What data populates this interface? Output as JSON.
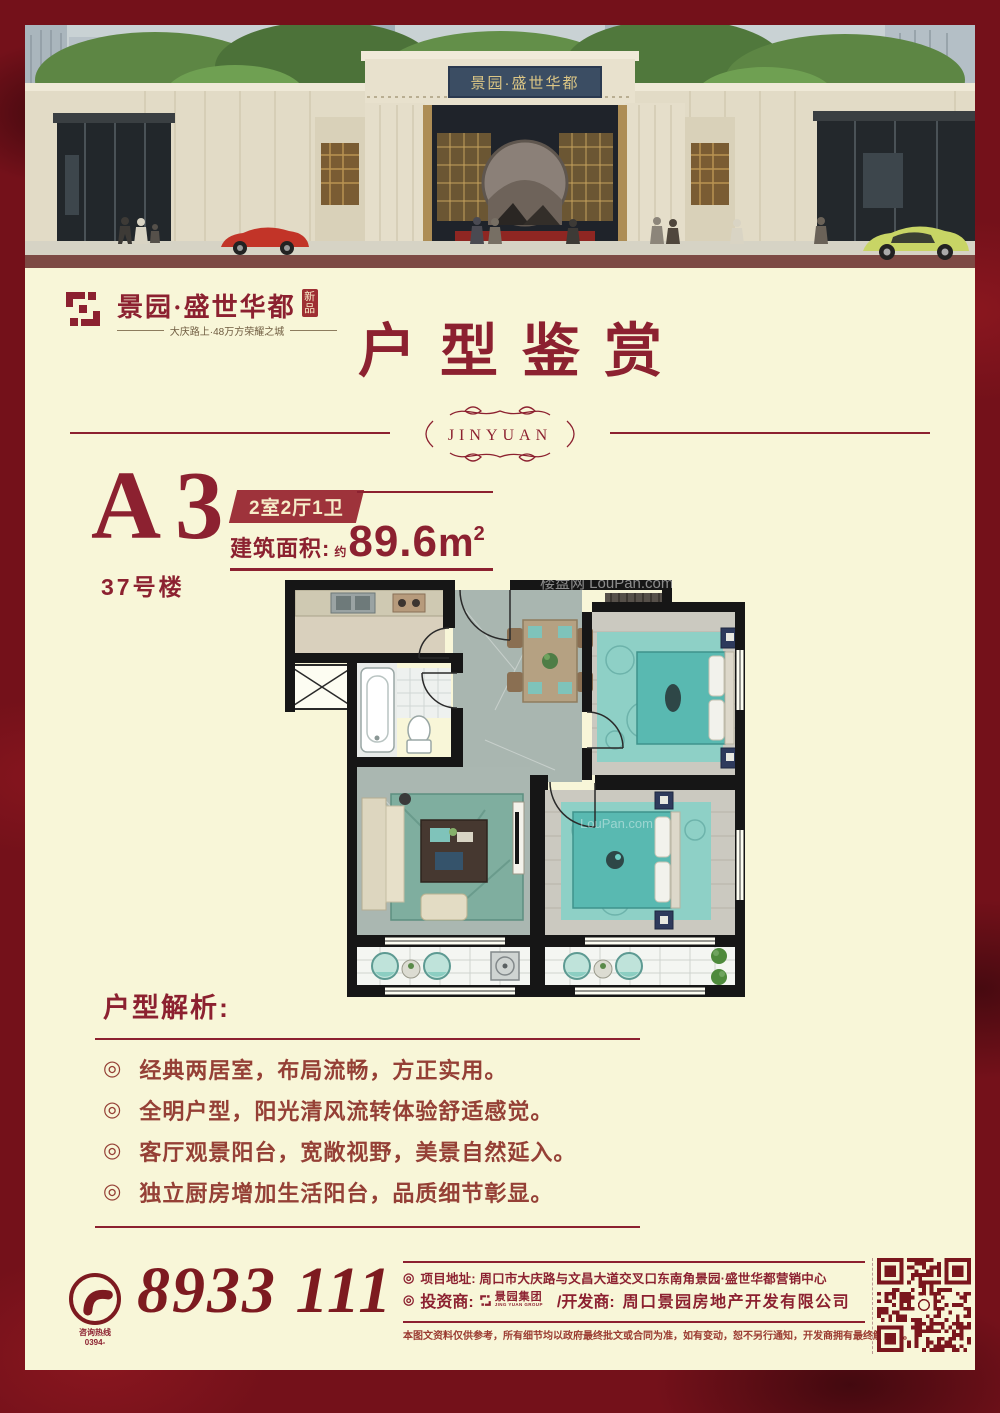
{
  "colors": {
    "accent": "#8c2130",
    "accent_dark": "#7a161d",
    "cream": "#f8f6d8",
    "frame_red": "#74111a",
    "badge_bg": "#9e333b",
    "bullet_text": "#954036",
    "plaque_navy": "#3b4d63",
    "plaque_gold": "#dcc685",
    "floorplan_teal": "#5fbdb5",
    "floorplan_navy": "#2e3a5c"
  },
  "brand": {
    "name": "景园·盛世华都",
    "badge": "新品",
    "tagline": "大庆路上·48万方荣耀之城"
  },
  "hero": {
    "plaque_text": "景园·盛世华都"
  },
  "header": {
    "title": "户型鉴赏",
    "ornament_text": "JINYUAN"
  },
  "unit": {
    "code": "A3",
    "building": "37号楼",
    "layout_badge": "2室2厅1卫",
    "area_label": "建筑面积:",
    "area_prefix": "约",
    "area_value": "89.6",
    "area_unit": "m",
    "area_power": "2"
  },
  "floorplan": {
    "watermark_top": "楼盘网 LouPan.com",
    "watermark_mid": "LouPan.com"
  },
  "analysis": {
    "heading": "户型解析:",
    "bullet_glyph": "◎",
    "items": [
      "经典两居室，布局流畅，方正实用。",
      "全明户型，阳光清风流转体验舒适感觉。",
      "客厅观景阳台，宽敞视野，美景自然延入。",
      "独立厨房增加生活阳台，品质细节彰显。"
    ]
  },
  "contact": {
    "bullet_glyph": "◎",
    "hotline_label": "咨询热线",
    "hotline_prefix": "0394-",
    "phone": "8933 111",
    "address_label": "项目地址:",
    "address": "周口市大庆路与文昌大道交叉口东南角景园·盛世华都营销中心",
    "investor_label": "投资商:",
    "investor_name": "景园集团",
    "investor_sub": "JING YUAN GROUP",
    "developer_label": "/开发商:",
    "developer": "周口景园房地产开发有限公司",
    "disclaimer": "本图文资料仅供参考，所有细节均以政府最终批文或合同为准，如有变动，恕不另行通知，开发商拥有最终解释权。"
  }
}
